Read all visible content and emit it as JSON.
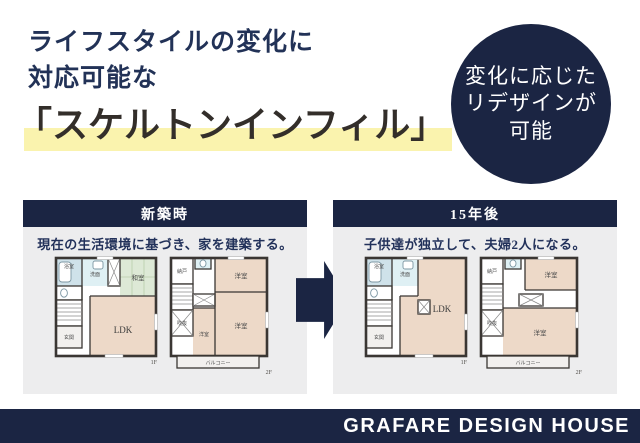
{
  "headline": {
    "line1": "ライフスタイルの変化に",
    "line2": "対応可能な",
    "title": "「スケルトンインフィル」"
  },
  "badge": {
    "line1": "変化に応じた",
    "line2": "リデザインが",
    "line3": "可能"
  },
  "panels": {
    "before": {
      "header": "新築時",
      "caption": "現在の生活環境に基づき、家を建築する。"
    },
    "after": {
      "header": "15年後",
      "caption": "子供達が独立して、夫婦2人になる。"
    }
  },
  "rooms": {
    "bath": "浴室",
    "wash": "洗面",
    "tatami": "和室",
    "entry": "玄関",
    "ldk": "LDK",
    "storage": "納戸",
    "void": "吹抜",
    "western": "洋室",
    "balcony": "バルコニー",
    "floor1": "1F",
    "floor2": "2F"
  },
  "footer": {
    "brand": "GRAFARE DESIGN HOUSE"
  },
  "colors": {
    "navy": "#1b2543",
    "title_dark": "#332e2a",
    "highlight_yellow": "#faf3ae",
    "panel_bg": "#ededee",
    "room_pink": "#edd9c8",
    "tatami_green": "#dde9d6",
    "bath_blue": "#cfe2ea",
    "wall": "#3a3633"
  }
}
